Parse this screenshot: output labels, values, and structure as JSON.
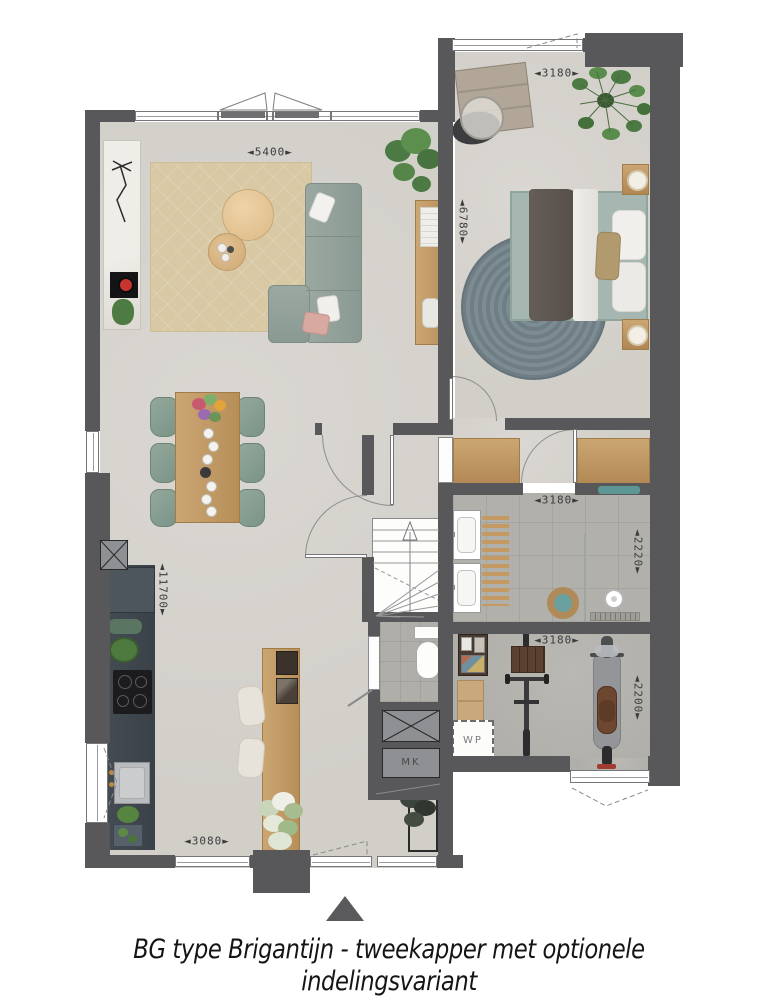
{
  "caption": "BG type Brigantijn - tweekapper met optionele indelingsvariant",
  "dimension_labels": {
    "living_width": "◄5400►",
    "bedroom_width": "◄3180►",
    "bedroom_depth": "◄6780►",
    "bathroom_width": "◄3180►",
    "bathroom_depth": "◄2220►",
    "storage_width": "◄3180►",
    "storage_depth": "◄2200►",
    "plan_depth": "◄11700►",
    "kitchen_width": "◄3080►"
  },
  "unit_labels": {
    "heat_pump": "WP",
    "meter_cupboard": "MK"
  },
  "colors": {
    "wall": "#58585a",
    "floor_light": "#d6d3ce",
    "floor_tile": "#b2b0ab",
    "floor_concrete": "#b5b3ae",
    "wood": "#c3996b",
    "sofa_green": "#94a29b",
    "rug_beige": "#d8c8a3",
    "round_rug_blue": "#76848b",
    "counter_dark": "#414850"
  }
}
